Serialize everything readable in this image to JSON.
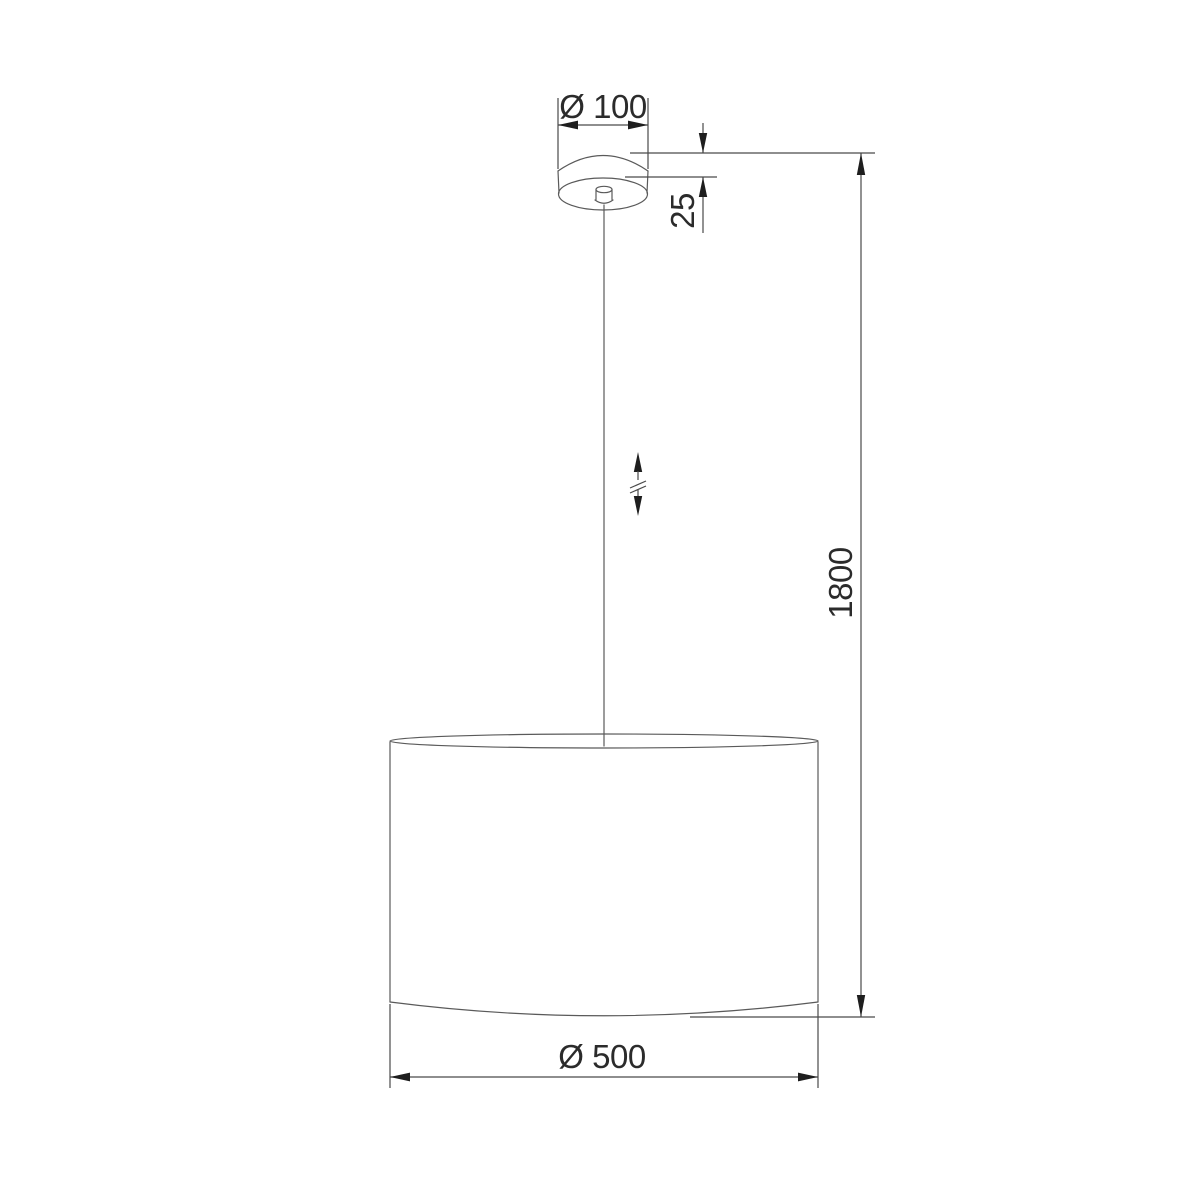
{
  "drawing": {
    "kind": "pendant-lamp-dimension-drawing",
    "background_color": "#ffffff",
    "object_line_color": "#5a5a5a",
    "dimension_line_color": "#4a4a4a",
    "arrow_color": "#1e1e1e",
    "text_color": "#2b2b2b",
    "components": [
      "ceiling-canopy",
      "cord-grip",
      "suspension-cord",
      "height-adjust-indicator",
      "cylindrical-lampshade"
    ],
    "dimensions": {
      "canopy_diameter": {
        "label": "Ø 100",
        "value": 100
      },
      "canopy_height": {
        "label": "25",
        "value": 25
      },
      "overall_height": {
        "label": "1800",
        "value": 1800
      },
      "shade_diameter": {
        "label": "Ø 500",
        "value": 500
      }
    },
    "symbols": {
      "height_adjustable": "double-headed-arrow-with-break-marks"
    }
  }
}
